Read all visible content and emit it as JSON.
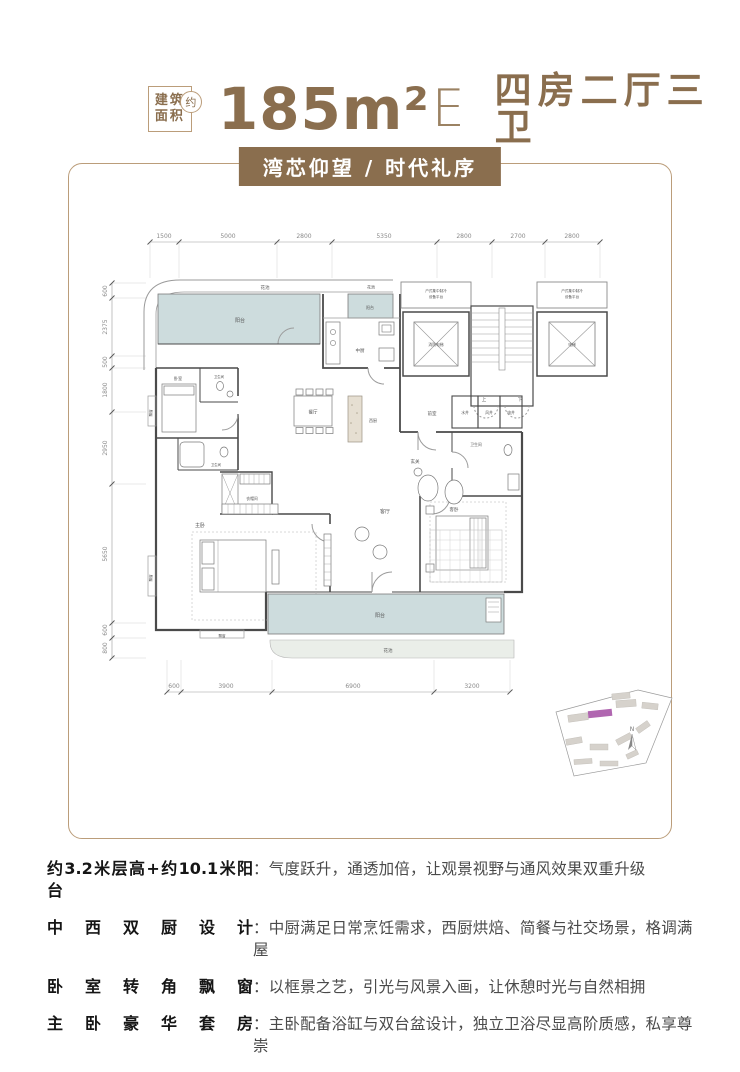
{
  "header": {
    "badge": {
      "line1": "建筑",
      "line2": "面积",
      "circle": "约"
    },
    "area_num": "185m²",
    "area_suffix": "E",
    "layout": "四房二厅三卫",
    "banner": "湾芯仰望 / 时代礼序"
  },
  "plan": {
    "dims": {
      "top": [
        "1500",
        "5000",
        "2800",
        "5350",
        "2800",
        "2700",
        "2800"
      ],
      "left": [
        "600",
        "2375",
        "500",
        "1800",
        "2950",
        "5650",
        "600",
        "800"
      ],
      "bottom": [
        "600",
        "3900",
        "6900",
        "3200"
      ]
    },
    "rooms": {
      "flower_bed": "花池",
      "balcony": "阳台",
      "chinese_kitchen": "中厨",
      "western_kitchen": "西厨",
      "dining": "餐厅",
      "living": "客厅",
      "master_bedroom": "主卧",
      "bedroom": "卧室",
      "guest_bedroom": "客卧",
      "bathroom": "卫生间",
      "cloakroom": "衣帽间",
      "foyer": "玄关",
      "bay_window": "飘窗"
    },
    "core": {
      "front_room": "前室",
      "platform_line1": "户式集中制冷",
      "platform_line2": "设备平台",
      "fire_elevator": "消防电梯",
      "elevator": "电梯",
      "stair_up": "上",
      "stair_down": "下",
      "water_shaft": "水井",
      "air_shaft": "风井",
      "electric_shaft": "电井"
    },
    "compass": "N"
  },
  "features": [
    {
      "label": "约3.2米层高+约10.1米阳台",
      "desc": "：气度跃升，通透加倍，让观景视野与通风效果双重升级"
    },
    {
      "label": "中西双厨设计",
      "desc": "：中厨满足日常烹饪需求，西厨烘焙、简餐与社交场景，格调满屋"
    },
    {
      "label": "卧室转角飘窗",
      "desc": "：以框景之艺，引光与风景入画，让休憩时光与自然相拥"
    },
    {
      "label": "主卧豪华套房",
      "desc": "：主卧配备浴缸与双台盆设计，独立卫浴尽显高阶质感，私享尊崇"
    }
  ],
  "colors": {
    "brand": "#8a6e4e",
    "frame_border": "#bb9d7a",
    "balcony_fill": "#cddcdd",
    "flower_fill": "#eaeee9",
    "site_highlight": "#b066b0"
  }
}
